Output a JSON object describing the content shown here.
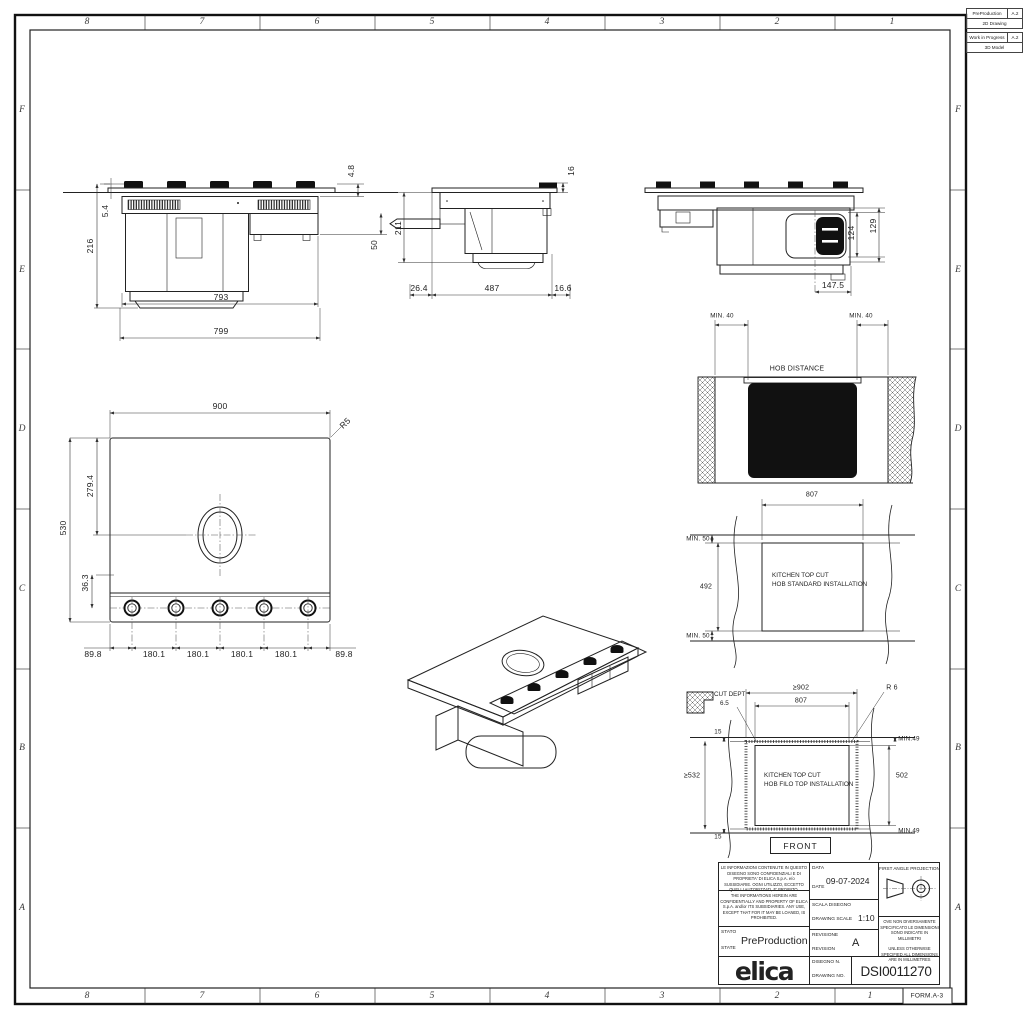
{
  "sheet": {
    "zone_numbers": [
      "8",
      "7",
      "6",
      "5",
      "4",
      "3",
      "2",
      "1"
    ],
    "zone_letters": [
      "F",
      "E",
      "D",
      "C",
      "B",
      "A"
    ],
    "form_label": "FORM.A-3"
  },
  "status_tables": {
    "t1": {
      "name": "PreProduction",
      "rev": "A.2",
      "type": "2D Drawing"
    },
    "t2": {
      "name": "Work in Progress",
      "rev": "A.2",
      "type": "3D Model"
    }
  },
  "front_view": {
    "total_height": "216",
    "glass_height": "5.4",
    "top_offset": "4.8",
    "duct_height": "50",
    "body_height": "211",
    "inner_width": "793",
    "outer_width": "799"
  },
  "side_view": {
    "top_offset": "16",
    "front_offset": "26.4",
    "body_depth": "487",
    "rear_offset": "16.6"
  },
  "back_view": {
    "motor_height": "124",
    "motor_total": "129",
    "motor_center": "147.5"
  },
  "plan_view": {
    "width": "900",
    "corner_radius": "R5",
    "vent_center": "279.4",
    "depth": "530",
    "knob_offset": "36.3",
    "spacings": [
      "89.8",
      "180.1",
      "180.1",
      "180.1",
      "180.1",
      "89.8"
    ]
  },
  "hob_distance_view": {
    "min_left": "MIN. 40",
    "min_right": "MIN. 40",
    "caption": "HOB DISTANCE"
  },
  "standard_cut_view": {
    "cut_width": "807",
    "min_top": "MIN. 50",
    "cut_depth": "492",
    "min_bottom": "MIN. 50",
    "caption_line1": "KITCHEN TOP CUT",
    "caption_line2": "HOB STANDARD INSTALLATION"
  },
  "filo_cut_view": {
    "cut_dept_label": "CUT DEPT",
    "cut_dept_value": "6.5",
    "outer_width": "≥902",
    "inner_width": "807",
    "corner_radius": "R 6",
    "edge_top": "15",
    "min_top": "MIN.49",
    "outer_depth": "≥532",
    "inner_depth": "502",
    "caption_line1": "KITCHEN TOP CUT",
    "caption_line2": "HOB FILO TOP INSTALLATION",
    "min_bottom": "MIN.49",
    "edge_bottom": "15",
    "front_label": "FRONT"
  },
  "title_block": {
    "confidential_it": "LE INFORMAZIONI CONTENUTE IN QUESTO DISEGNO SONO CONFIDENZIALI E DI PROPRIETA' DI ELICA S.p.A. e/o SUSSIDIARIE. OGNI UTILIZZO, ECCETTO QUELLI AUTORIZZATI, E' PROIBITO.",
    "confidential_en": "THE INFORMATIONS HEREIN ARE CONFIDENTIALLY AND PROPERTY OF ELICA S.p.A. and/or ITS SUBSIDIARIES. ANY USE, EXCEPT THAT FOR IT MAY BE LOANED, IS PROHIBITED.",
    "date_label_it": "DATA",
    "date_label_en": "DATE",
    "date_value": "09-07-2024",
    "scale_label_it": "SCALA DISEGNO",
    "scale_label_en": "DRAWING SCALE",
    "scale_value": "1:10",
    "state_label_it": "STATO",
    "state_label_en": "STATE",
    "state_value": "PreProduction",
    "revision_label_it": "REVISIONE",
    "revision_label_en": "REVISION",
    "revision_value": "A",
    "drawing_no_label_it": "DISEGNO N.",
    "drawing_no_label_en": "DRAWING NO.",
    "drawing_no_value": "DSI0011270",
    "projection_label": "FIRST ANGLE PROJECTION",
    "units_note_it": "OVE NON DIVERSAMENTE SPECIFICATO LE DIMENSIONI SONO INDICATE IN MILLIMETRI",
    "units_note_en": "UNLESS OTHERWISE SPECIFIED ALL DIMENSIONS ARE IN MILLIMETRES",
    "logo": "elica"
  }
}
